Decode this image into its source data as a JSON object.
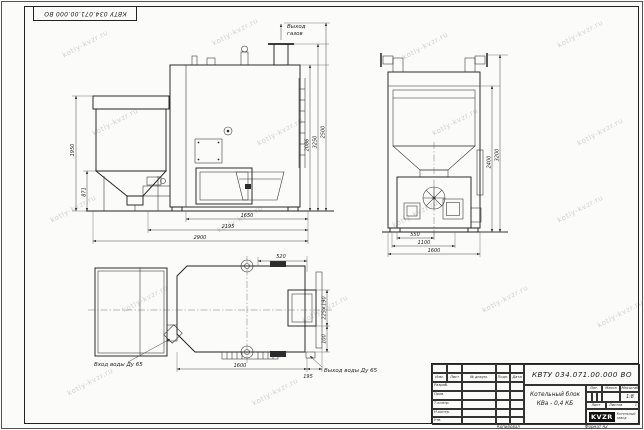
{
  "watermark": {
    "text": "kotly-kvzr.ru"
  },
  "corner_stamp": "КВТУ 034.071.00.000 ВО",
  "views": {
    "front": {
      "gas_outlet_line1": "Выход",
      "gas_outlet_line2": "газов",
      "dim_bottom_1": "1650",
      "dim_bottom_2": "2195",
      "dim_bottom_3": "2900",
      "dim_left_inner": "871",
      "dim_left_outer": "1950",
      "dim_right_1": "2086",
      "dim_right_2": "3250",
      "dim_right_3": "2500"
    },
    "side": {
      "dim_bottom_1": "550",
      "dim_bottom_2": "1100",
      "dim_bottom_3": "1600",
      "dim_right_1": "2400",
      "dim_right_2": "3200"
    },
    "plan": {
      "water_inlet_label": "Вход воды Ду 65",
      "water_outlet_label": "Выход воды Ду 65",
      "dim_top": "520",
      "dim_flue": "225×190",
      "dim_right_offset": "100",
      "dim_bottom": "1600",
      "dim_bottom_right": "195"
    }
  },
  "title_block": {
    "doc_number": "КВТУ 034.071.00.000 ВО",
    "product_name_1": "Котельный блок",
    "product_name_2": "КВа - 0,4 КБ",
    "col_izm": "Изм.",
    "col_list": "Лист",
    "col_docnum": "№ докум.",
    "col_podp": "Подп.",
    "col_data": "Дата",
    "row_razrab": "Разраб.",
    "row_prov": "Пров.",
    "row_tkontr": "Т.контр.",
    "row_nkontr": "Н.контр.",
    "row_utv": "Утв.",
    "hdr_lit": "Лит.",
    "hdr_mass": "Масса",
    "hdr_scale": "Масштаб",
    "scale_value": "1:8",
    "hdr_sheet": "Лист",
    "hdr_sheets": "Листов",
    "sheets_value": "1",
    "logo_text": "KVZR",
    "logo_caption_1": "Котельный",
    "logo_caption_2": "завод",
    "footer_copy": "Копировал",
    "footer_format": "Формат А2"
  }
}
